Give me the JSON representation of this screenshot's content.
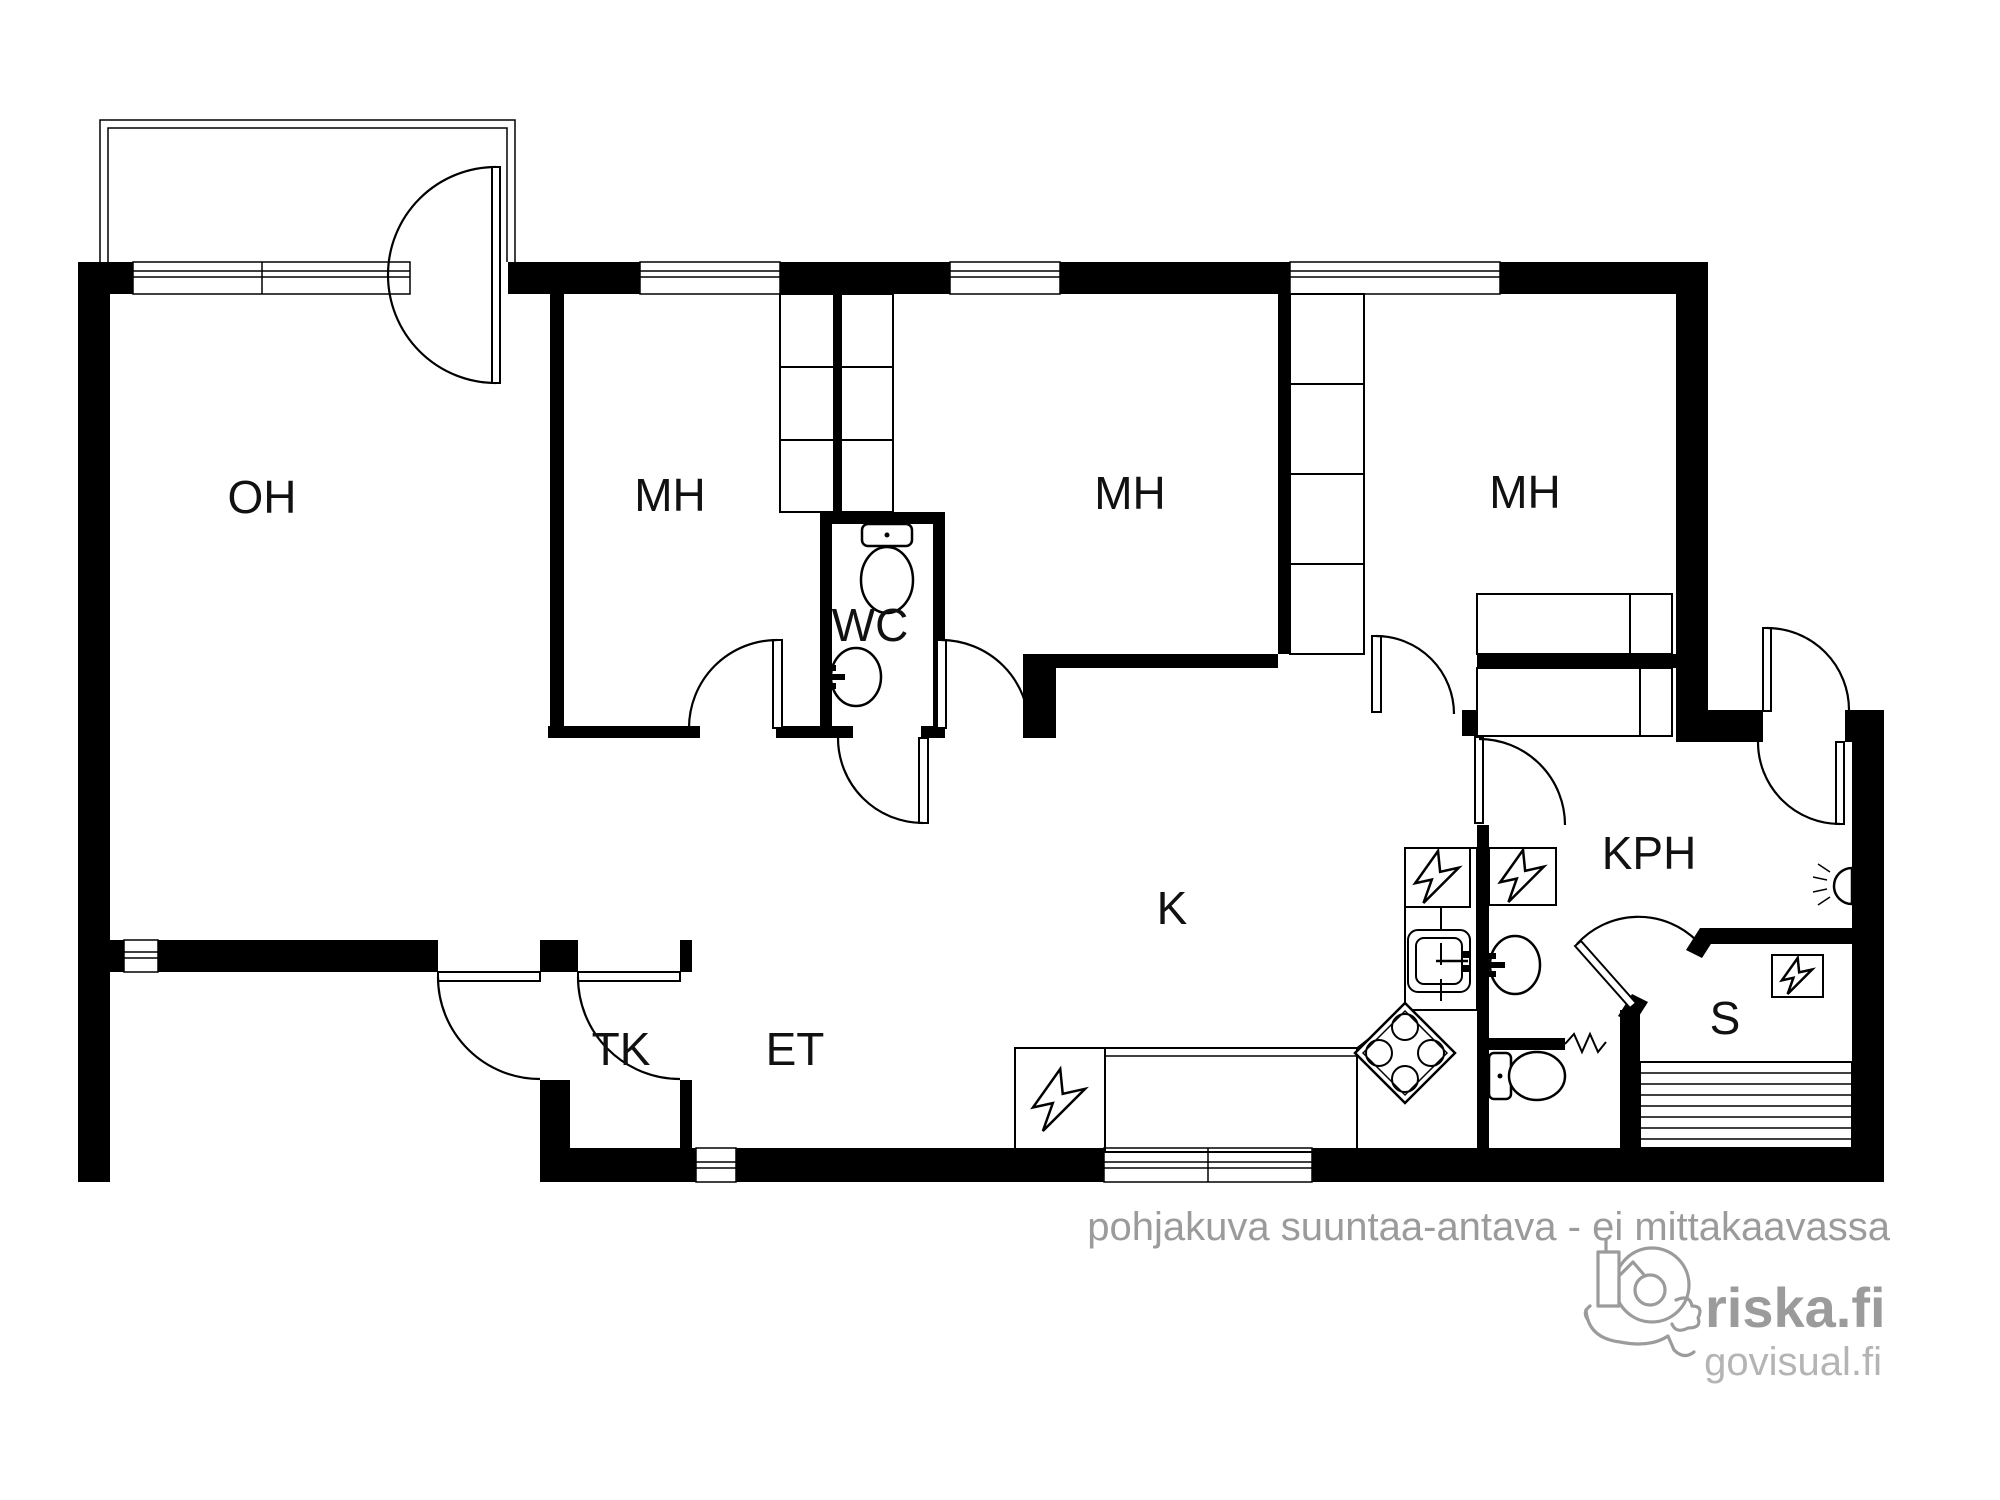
{
  "document": {
    "type": "apartment-floor-plan",
    "background": "#ffffff"
  },
  "rooms": [
    {
      "id": "oh",
      "label": "OH",
      "x": 262,
      "y": 497,
      "meaning": "living room"
    },
    {
      "id": "mh-1",
      "label": "MH",
      "x": 670,
      "y": 495,
      "meaning": "bedroom"
    },
    {
      "id": "mh-2",
      "label": "MH",
      "x": 1130,
      "y": 493,
      "meaning": "bedroom"
    },
    {
      "id": "mh-3",
      "label": "MH",
      "x": 1525,
      "y": 492,
      "meaning": "bedroom"
    },
    {
      "id": "wc",
      "label": "WC",
      "x": 870,
      "y": 625,
      "meaning": "toilet"
    },
    {
      "id": "k",
      "label": "K",
      "x": 1172,
      "y": 908,
      "meaning": "kitchen"
    },
    {
      "id": "tk",
      "label": "TK",
      "x": 621,
      "y": 1049,
      "meaning": "vestibule"
    },
    {
      "id": "et",
      "label": "ET",
      "x": 795,
      "y": 1049,
      "meaning": "entrance hall"
    },
    {
      "id": "kph",
      "label": "KPH",
      "x": 1649,
      "y": 853,
      "meaning": "bathroom"
    },
    {
      "id": "s",
      "label": "S",
      "x": 1725,
      "y": 1018,
      "meaning": "sauna"
    }
  ],
  "watermark": "pohjakuva suuntaa-antava - ei mittakaavassa",
  "branding": {
    "site": "riska.fi",
    "subsite": "govisual.fi",
    "logo_icon": "riska-city-in-hand-logo-icon"
  },
  "colors": {
    "walls": "#000000",
    "labels": "#111111",
    "watermark": "#9b9b9b",
    "branding": "#9b9b9b",
    "branding_sub": "#b4b4b4"
  },
  "symbols": [
    {
      "name": "toilet-icon",
      "count": 2
    },
    {
      "name": "sink-icon",
      "count": 3
    },
    {
      "name": "stove-icon",
      "count": 1
    },
    {
      "name": "appliance-lightning-icon",
      "count": 4
    },
    {
      "name": "sauna-bench-icon",
      "count": 1
    },
    {
      "name": "sauna-heater-icon",
      "count": 1
    },
    {
      "name": "wall-lamp-icon",
      "count": 1
    },
    {
      "name": "heater-zigzag-icon",
      "count": 1
    },
    {
      "name": "door-swing-arc",
      "count": 12
    },
    {
      "name": "window-symbol",
      "count": 7
    },
    {
      "name": "wardrobe-cells",
      "count": 4
    },
    {
      "name": "balcony-outline",
      "count": 1
    }
  ]
}
